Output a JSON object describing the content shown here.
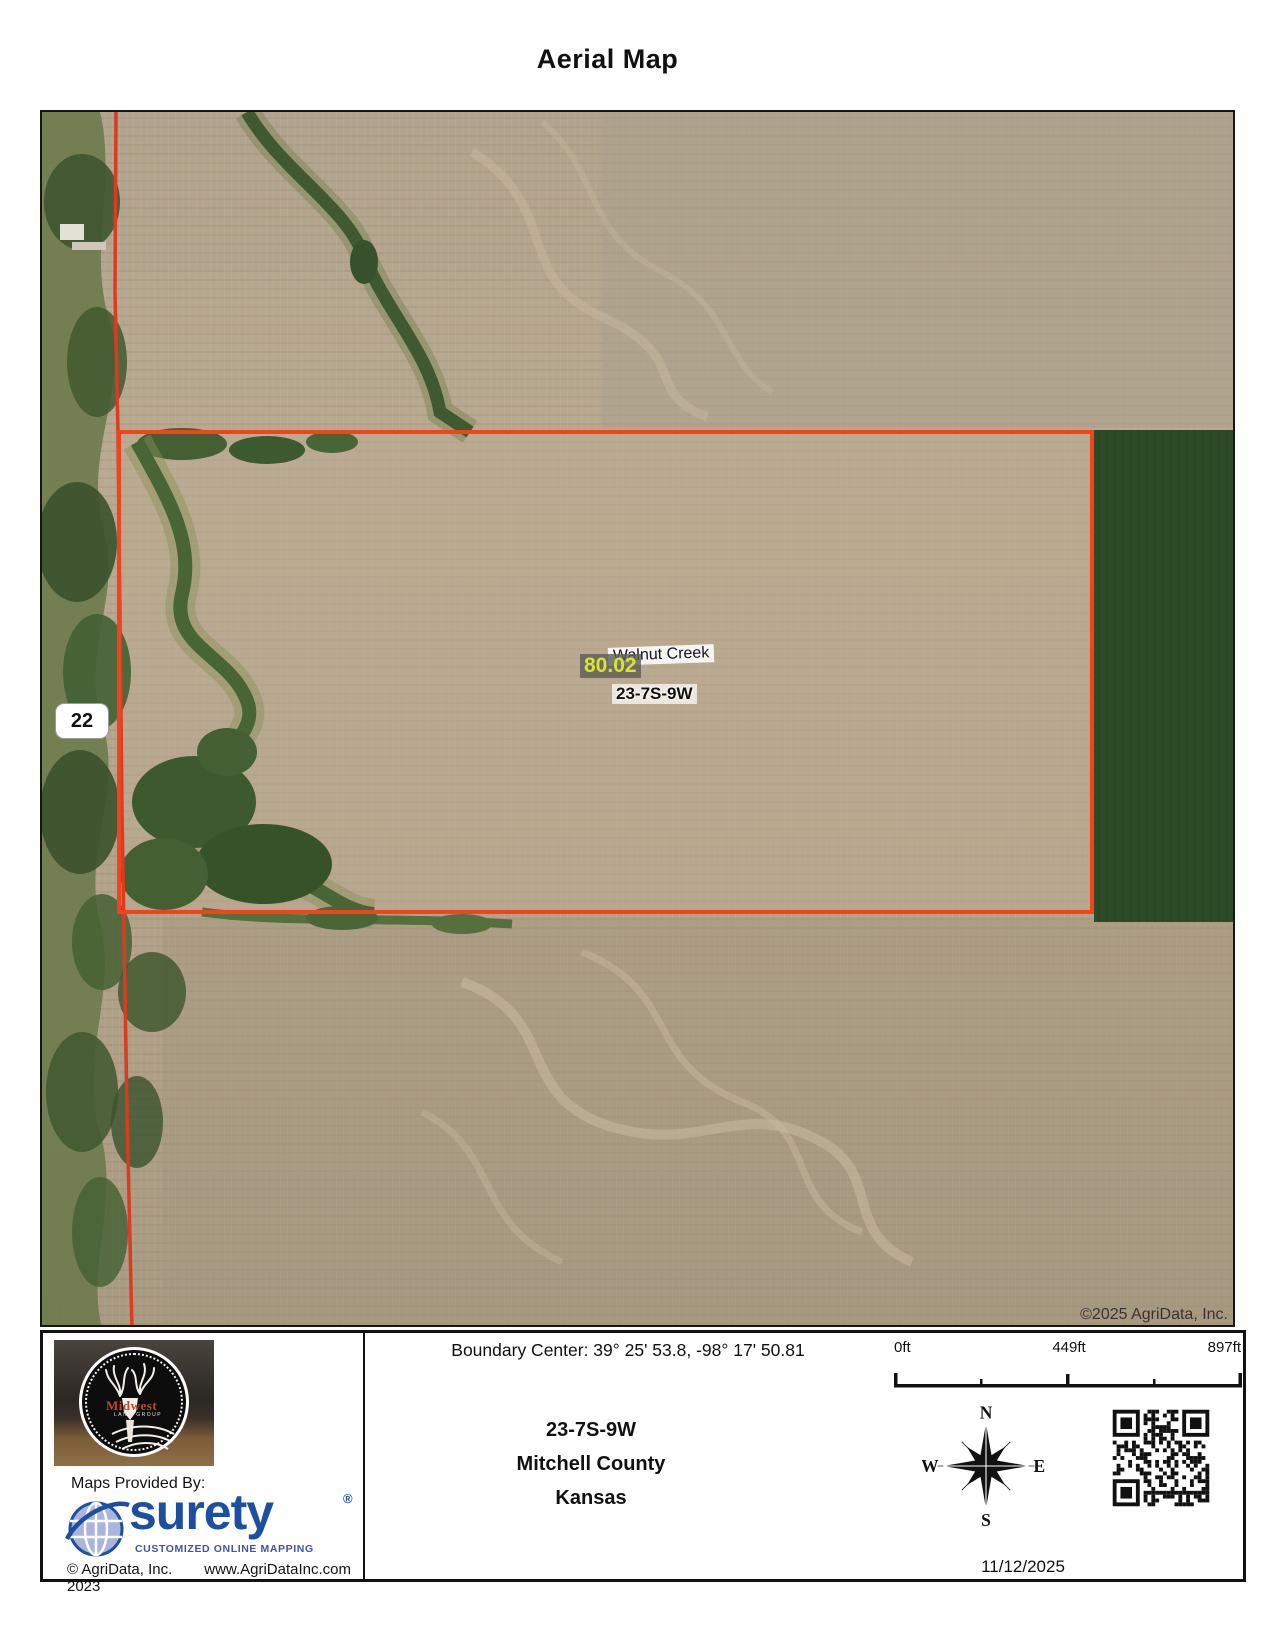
{
  "page": {
    "title": "Aerial Map"
  },
  "map": {
    "labels": {
      "acreage": "80.02",
      "creek": "Walnut Creek",
      "section": "23-7S-9W",
      "road_number": "22"
    },
    "copyright": "©2025 AgriData, Inc.",
    "boundary_color": "#f4421c",
    "acreage_text_color": "#d9e42c"
  },
  "footer": {
    "boundary_center": "Boundary Center: 39° 25' 53.8,  -98° 17' 50.81",
    "location": {
      "section": "23-7S-9W",
      "county": "Mitchell County",
      "state": "Kansas"
    },
    "scale": {
      "zero": "0ft",
      "mid": "449ft",
      "max": "897ft"
    },
    "compass": {
      "n": "N",
      "s": "S",
      "e": "E",
      "w": "W"
    },
    "midwest_logo": {
      "name": "Midwest",
      "subtitle": "LAND GROUP"
    },
    "maps_provided_by": "Maps Provided By:",
    "surety": {
      "name": "surety",
      "registered": "®",
      "tagline": "CUSTOMIZED ONLINE MAPPING",
      "brand_color": "#1d4fa1"
    },
    "copyright": "© AgriData, Inc. 2023",
    "website": "www.AgriDataInc.com",
    "date": "11/12/2025"
  }
}
